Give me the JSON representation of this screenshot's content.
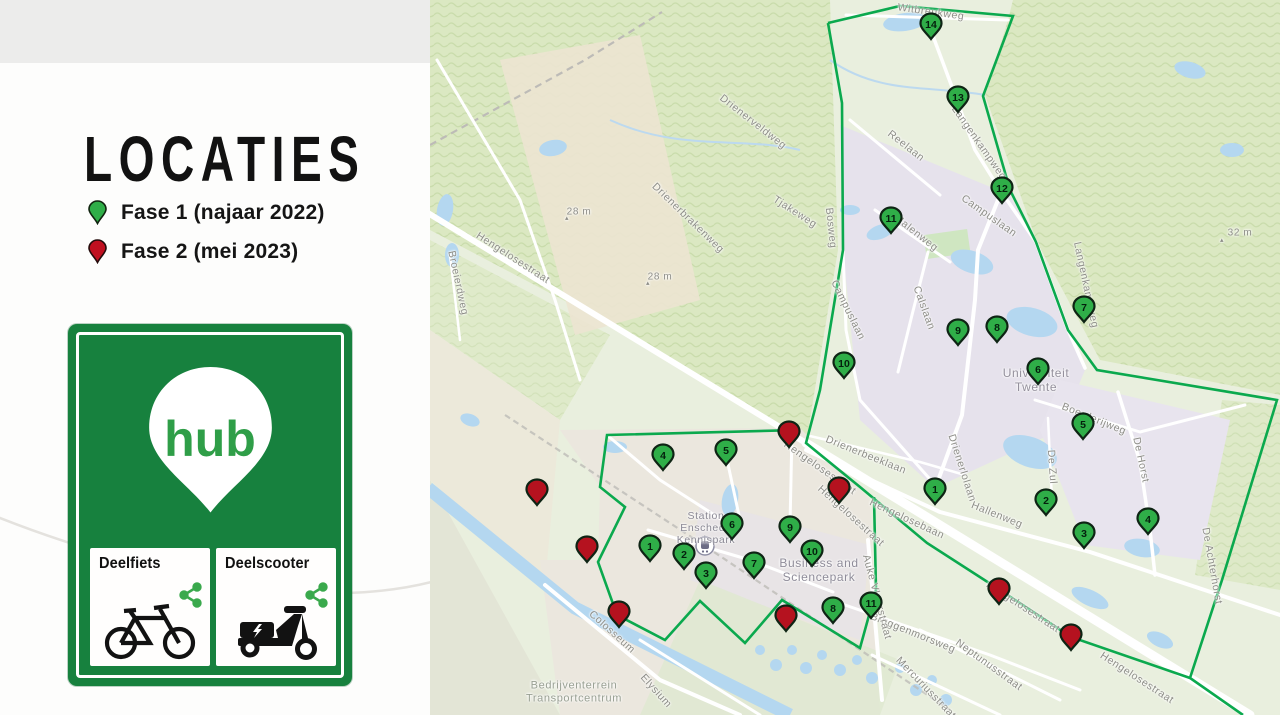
{
  "panel": {
    "title": "LOCATIES",
    "legend": [
      {
        "label": "Fase 1 (najaar 2022)",
        "color": "#2fae48"
      },
      {
        "label": "Fase 2 (mei 2023)",
        "color": "#c01020"
      }
    ],
    "sign": {
      "brand": "hub",
      "services": [
        {
          "label": "Deelfiets",
          "icon": "bicycle-icon"
        },
        {
          "label": "Deelscooter",
          "icon": "scooter-icon"
        }
      ]
    }
  },
  "map": {
    "phase1_color": "#2fae48",
    "phase2_color": "#b5121f",
    "marker_outline": "#0e2414",
    "boundary_color": "#0ba94e",
    "markers_phase1_campus": [
      {
        "n": "1",
        "x": 935,
        "y": 489
      },
      {
        "n": "2",
        "x": 1046,
        "y": 500
      },
      {
        "n": "3",
        "x": 1084,
        "y": 533
      },
      {
        "n": "4",
        "x": 1148,
        "y": 519
      },
      {
        "n": "5",
        "x": 1083,
        "y": 424
      },
      {
        "n": "6",
        "x": 1038,
        "y": 369
      },
      {
        "n": "7",
        "x": 1084,
        "y": 307
      },
      {
        "n": "8",
        "x": 997,
        "y": 327
      },
      {
        "n": "9",
        "x": 958,
        "y": 330
      },
      {
        "n": "10",
        "x": 844,
        "y": 363
      },
      {
        "n": "11",
        "x": 891,
        "y": 218
      },
      {
        "n": "12",
        "x": 1002,
        "y": 188
      },
      {
        "n": "13",
        "x": 958,
        "y": 97
      },
      {
        "n": "14",
        "x": 931,
        "y": 24
      }
    ],
    "markers_phase1_sciencepark": [
      {
        "n": "1",
        "x": 650,
        "y": 546
      },
      {
        "n": "2",
        "x": 684,
        "y": 554
      },
      {
        "n": "3",
        "x": 706,
        "y": 573
      },
      {
        "n": "4",
        "x": 663,
        "y": 455
      },
      {
        "n": "5",
        "x": 726,
        "y": 450
      },
      {
        "n": "6",
        "x": 732,
        "y": 524
      },
      {
        "n": "7",
        "x": 754,
        "y": 563
      },
      {
        "n": "8",
        "x": 833,
        "y": 608
      },
      {
        "n": "9",
        "x": 790,
        "y": 527
      },
      {
        "n": "10",
        "x": 812,
        "y": 551
      },
      {
        "n": "11",
        "x": 871,
        "y": 603
      }
    ],
    "markers_phase2": [
      {
        "x": 537,
        "y": 490
      },
      {
        "x": 587,
        "y": 547
      },
      {
        "x": 619,
        "y": 612
      },
      {
        "x": 789,
        "y": 432
      },
      {
        "x": 839,
        "y": 488
      },
      {
        "x": 786,
        "y": 616
      },
      {
        "x": 999,
        "y": 589
      },
      {
        "x": 1071,
        "y": 635
      }
    ],
    "boundary": [
      {
        "points": "828,23 900,6 1013,16 983,96 1010,190 1036,242 1068,330 1097,370 1277,400 1222,580 1190,678 1243,715"
      },
      {
        "points": "828,23 842,103 843,250 820,390 806,443 860,487 927,543 1000,590 1071,637 1190,678"
      },
      {
        "points": "800,430 607,435 600,487 625,507 598,562 617,615 665,640 700,601 745,643 782,600 860,648 876,590 874,497"
      }
    ],
    "labels": [
      {
        "t": "Witbreukweg",
        "x": 931,
        "y": 12,
        "r": 8
      },
      {
        "t": "Drienerveldweg",
        "x": 753,
        "y": 122,
        "r": 38
      },
      {
        "t": "Tjakeweg",
        "x": 795,
        "y": 212,
        "r": 33
      },
      {
        "t": "Drienerbrakenweg",
        "x": 688,
        "y": 218,
        "r": 44
      },
      {
        "t": "▴",
        "x": 567,
        "y": 219,
        "s": 7
      },
      {
        "t": "28 m",
        "x": 579,
        "y": 212,
        "s": 10
      },
      {
        "t": "▴",
        "x": 648,
        "y": 284,
        "s": 7
      },
      {
        "t": "28 m",
        "x": 660,
        "y": 277,
        "s": 10
      },
      {
        "t": "▴",
        "x": 1222,
        "y": 241,
        "s": 7
      },
      {
        "t": "32 m",
        "x": 1240,
        "y": 233,
        "s": 10
      },
      {
        "t": "Hengelosestraat",
        "x": 513,
        "y": 258,
        "r": 33
      },
      {
        "t": "Broeierdweg",
        "x": 458,
        "y": 283,
        "r": 78
      },
      {
        "t": "Reelaan",
        "x": 906,
        "y": 146,
        "r": 38
      },
      {
        "t": "Langenkampweg",
        "x": 979,
        "y": 143,
        "r": 55
      },
      {
        "t": "Bosweg",
        "x": 831,
        "y": 228,
        "r": 84
      },
      {
        "t": "Malenweg",
        "x": 916,
        "y": 233,
        "r": 38
      },
      {
        "t": "Campuslaan",
        "x": 989,
        "y": 216,
        "r": 35
      },
      {
        "t": "Campuslaan",
        "x": 848,
        "y": 310,
        "r": 64
      },
      {
        "t": "Calslaan",
        "x": 924,
        "y": 308,
        "r": 70
      },
      {
        "t": "Langenkampweg",
        "x": 1086,
        "y": 285,
        "r": 78
      },
      {
        "t": [
          "Universiteit",
          "Twente"
        ],
        "x": 1036,
        "y": 381,
        "s": 12,
        "c": "#94909c"
      },
      {
        "t": "Boerderijweg",
        "x": 1094,
        "y": 419,
        "r": 22
      },
      {
        "t": "De Horst",
        "x": 1141,
        "y": 460,
        "r": 78
      },
      {
        "t": "De Zul",
        "x": 1052,
        "y": 467,
        "r": 86
      },
      {
        "t": "Drienerlolaan",
        "x": 962,
        "y": 468,
        "r": 72
      },
      {
        "t": "Hallenweg",
        "x": 997,
        "y": 515,
        "r": 22
      },
      {
        "t": "Drienerbeeklaan",
        "x": 866,
        "y": 455,
        "r": 22
      },
      {
        "t": "Hengelosestraat",
        "x": 820,
        "y": 468,
        "r": 35
      },
      {
        "t": "Hengelosestraat",
        "x": 851,
        "y": 516,
        "r": 42
      },
      {
        "t": "Hengelosebaan",
        "x": 907,
        "y": 519,
        "r": 25
      },
      {
        "t": [
          "Station",
          "Enschede",
          "Kennispark"
        ],
        "x": 706,
        "y": 528,
        "c": "#8a8894"
      },
      {
        "t": [
          "Business and",
          "Sciencepark"
        ],
        "x": 819,
        "y": 571,
        "s": 12,
        "c": "#8f8c99"
      },
      {
        "t": "Colosseum",
        "x": 612,
        "y": 632,
        "r": 42
      },
      {
        "t": "Elysium",
        "x": 656,
        "y": 691,
        "r": 48
      },
      {
        "t": [
          "Bedrijventerrein",
          "Transportcentrum"
        ],
        "x": 574,
        "y": 692,
        "s": 11,
        "c": "#99a093"
      },
      {
        "t": "Bruggenmorsweg",
        "x": 913,
        "y": 633,
        "r": 22
      },
      {
        "t": "Neptunusstraat",
        "x": 989,
        "y": 665,
        "r": 36
      },
      {
        "t": "Mercuriusstraat",
        "x": 926,
        "y": 688,
        "r": 46
      },
      {
        "t": "Auke Vleerstraat",
        "x": 877,
        "y": 597,
        "r": 75
      },
      {
        "t": "Hengelosestraat",
        "x": 1023,
        "y": 607,
        "r": 33
      },
      {
        "t": "Hengelosestraat",
        "x": 1137,
        "y": 678,
        "r": 33
      },
      {
        "t": "De Achterhorst",
        "x": 1212,
        "y": 566,
        "r": 80
      }
    ]
  }
}
